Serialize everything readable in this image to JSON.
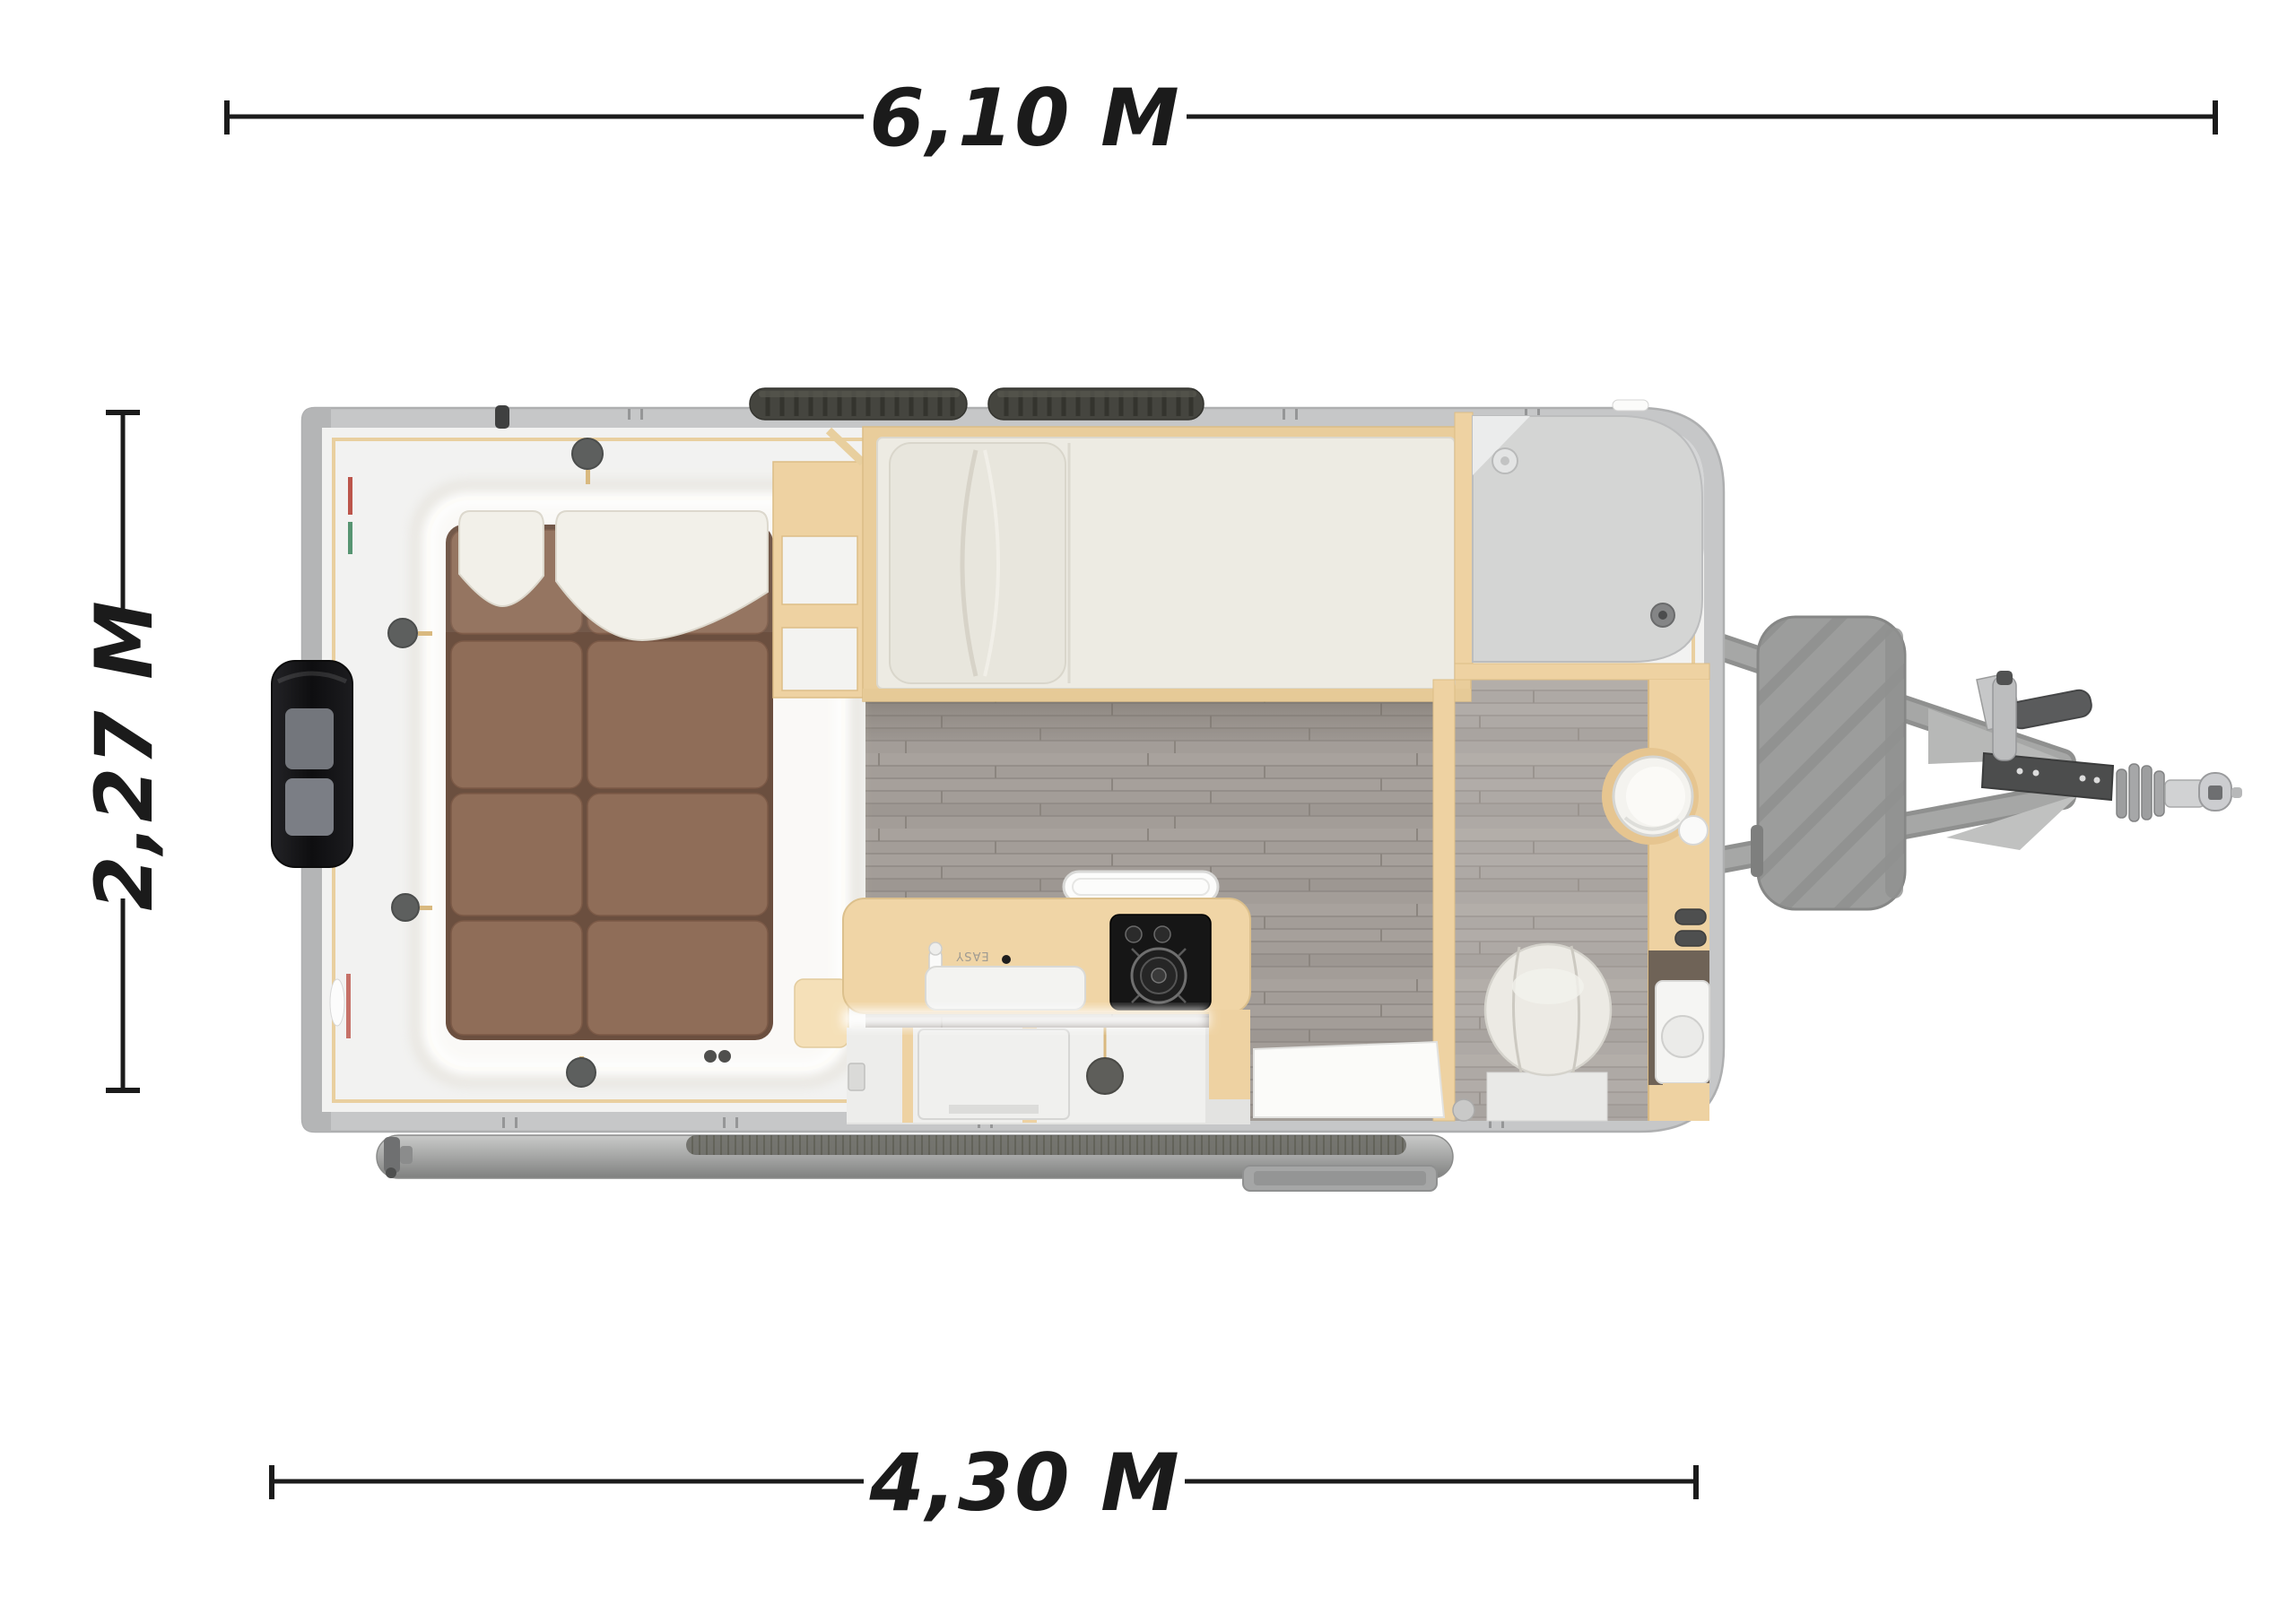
{
  "diagram": {
    "type": "caravan-floorplan-top-view",
    "dimensions": {
      "top": {
        "label": "6,10 M"
      },
      "left": {
        "label": "2,27 M"
      },
      "bottom": {
        "label": "4,30 M"
      }
    },
    "kitchen": {
      "sink_brand_label": "EASY"
    },
    "colors": {
      "background": "#ffffff",
      "dimension_ink": "#1b1b1b",
      "body_shell_gray": "#c6c7c8",
      "interior_white": "#f2f2f1",
      "wood_birch": "#eed2a2",
      "floor_gray_brown": "#a39d98",
      "cushion_brown": "#8f6d58",
      "pillow_white": "#f2f0e9",
      "mattress_cream": "#edebe3",
      "shower_tray_gray": "#d4d5d4",
      "stove_black": "#161616",
      "tire_black": "#45453f",
      "rear_box_black": "#141416",
      "hitch_gray": "#9c9d9c",
      "led_glow": "#ffffff"
    }
  }
}
